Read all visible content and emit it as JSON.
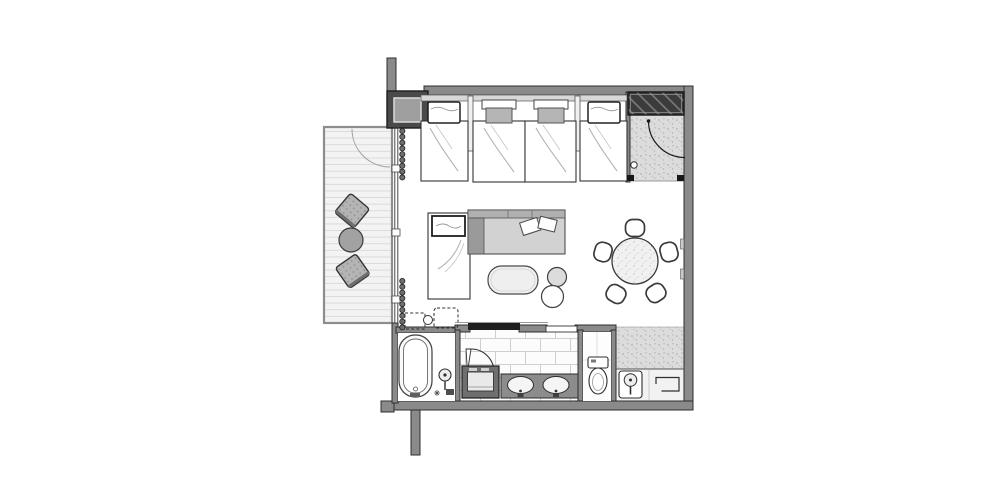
{
  "canvas": {
    "width": 1000,
    "height": 497,
    "background": "#ffffff"
  },
  "plan": {
    "kind": "guest-room-floor-plan",
    "rooms": [
      "balcony",
      "bedroom-living-area",
      "entry-upper",
      "entry-lower",
      "bathroom",
      "washroom",
      "toilet"
    ],
    "furniture_counts": {
      "twin_beds": 4,
      "daybed": 1,
      "sofa": 1,
      "sofa_pillows": 2,
      "coffee_table": 1,
      "poufs": 2,
      "dining_table": 1,
      "dining_chairs": 5,
      "balcony_chairs": 2,
      "balcony_table": 1,
      "bathtub": 1,
      "shower_head": 1,
      "laundry_cabinet": 1,
      "vanity_sinks": 2,
      "toilet": 1,
      "hand_basin": 1,
      "closet": 1
    }
  },
  "colors": {
    "wall": "#8a8a8a",
    "wall_dark": "#4a4a4a",
    "wall_edge": "#2e2e2e",
    "slider_bar": "#1f1f1f",
    "deck": "#f3f3f3",
    "deck_line": "#d9d9d9",
    "entry_floor": "#dcdcdc",
    "closet": "#3b3b3b",
    "tile_floor": "#fcfcfc",
    "sofa_seat": "#d2d2d2",
    "sofa_back": "#b0b0b0",
    "sofa_side": "#9a9a9a",
    "counter": "#8c8c8c",
    "cabinet": "#6f6f6f",
    "headboard_ledge": "#d8d8d8",
    "bed_cushion": "#b5b5b5",
    "pouf": "#dcdcdc",
    "balcony_table": "#a2a2a2",
    "balcony_chair": "#b4b4b4",
    "dining_table": "#f1f1f1"
  }
}
